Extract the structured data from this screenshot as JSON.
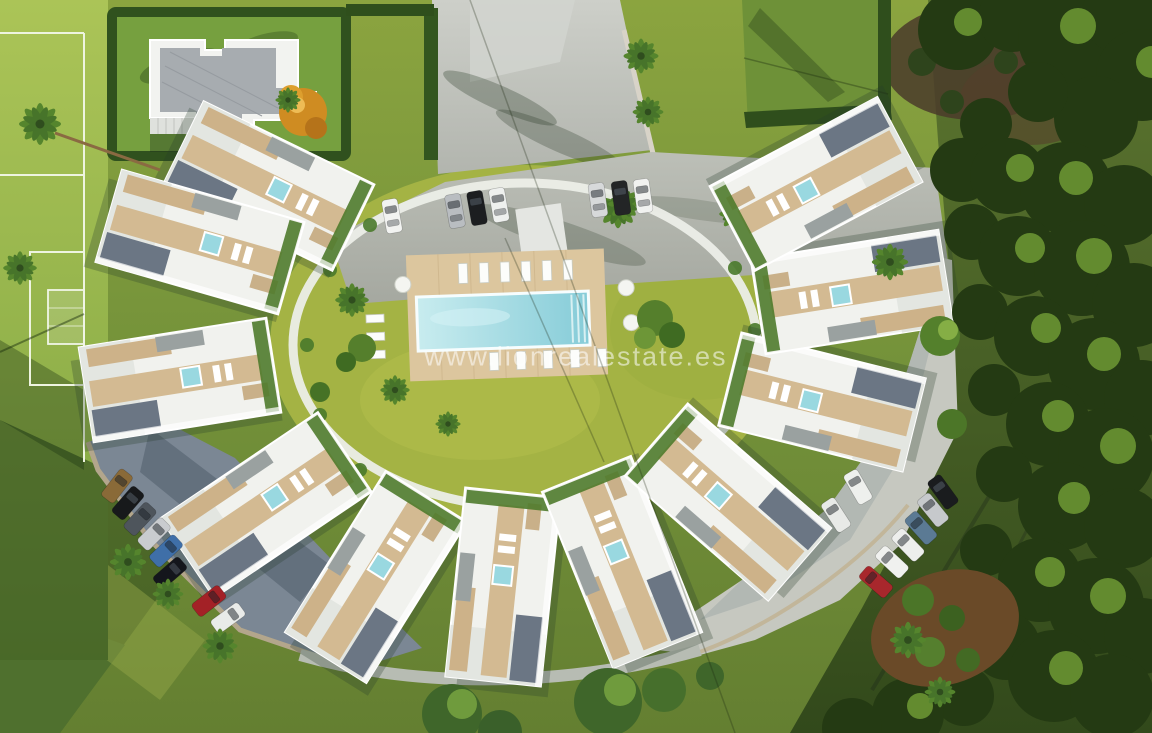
{
  "scene": {
    "type": "aerial-3d-architectural-render",
    "subject": "curved white apartment complex around a central garden with swimming pool"
  },
  "watermark": {
    "text": "www.lionrealestate.es",
    "color": "#ffffff",
    "opacity": 0.55
  },
  "palette": {
    "lawn": "#7c9738",
    "sports_field": "#9db84e",
    "courtyard_lawn": "#a4b344",
    "building_white": "#f1f2ee",
    "terrace_wood": "#d3ba92",
    "roof_gravel": "#6b7684",
    "pool_water": "#9ad9e0",
    "asphalt_shaded": "#7b8794",
    "pavement_light": "#c3c5bd",
    "hedge": "#30511e",
    "forest_dark": "#243a13",
    "orange_tree": "#cf8c22"
  },
  "objects": {
    "cars_top_row": [
      "white",
      "silver",
      "black",
      "white",
      "silver",
      "black",
      "white"
    ],
    "cars_bottom_left": [
      "tan",
      "black",
      "gray",
      "silver",
      "blue",
      "navy",
      "red",
      "white"
    ],
    "cars_bottom_right": [
      "black",
      "silver",
      "steel-blue",
      "white",
      "white",
      "red",
      "white",
      "white"
    ],
    "pool": {
      "shape": "rectangular",
      "sun_loungers": 14,
      "round_tables": 3
    },
    "sports_field": {
      "type": "football-pitch",
      "goals_visible": 1
    }
  }
}
